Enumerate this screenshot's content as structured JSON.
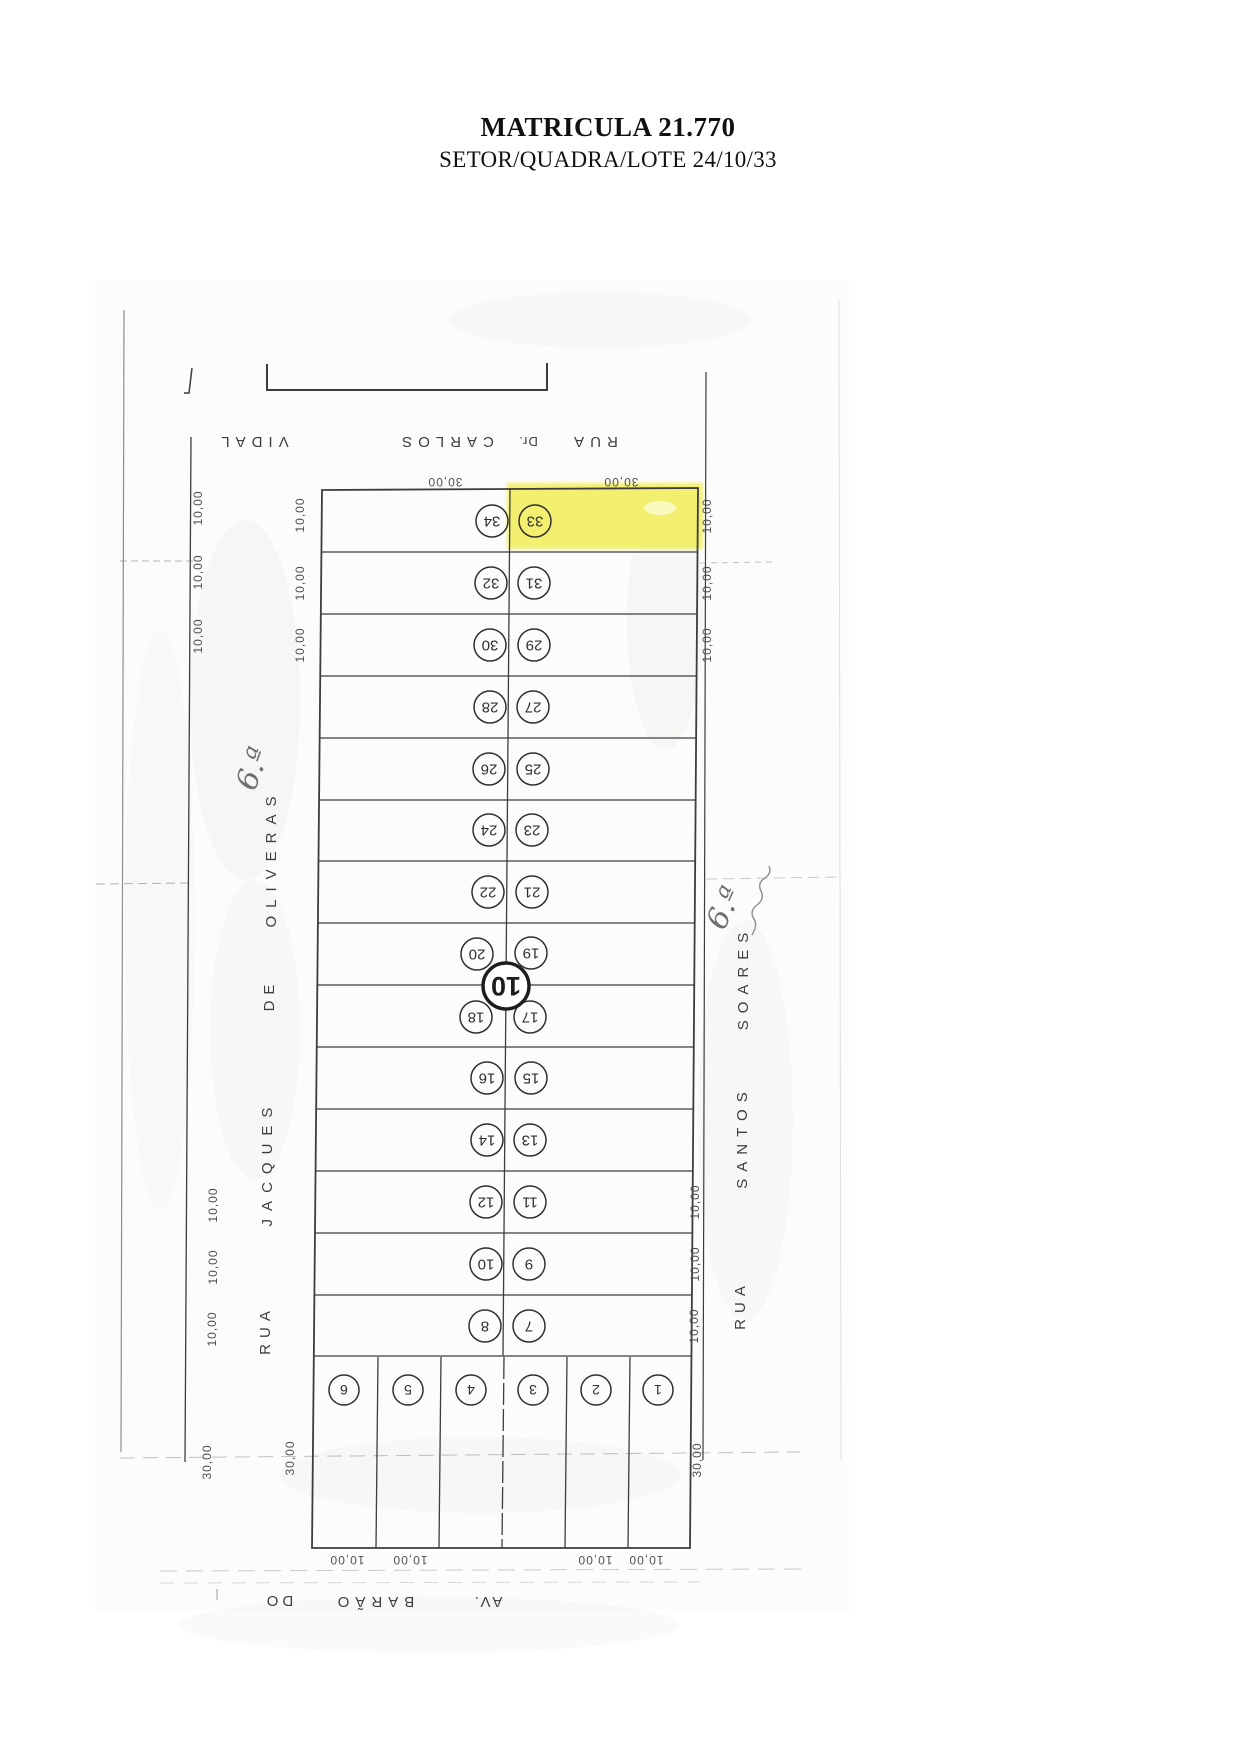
{
  "title": {
    "line1": "MATRICULA 21.770",
    "line2": "SETOR/QUADRA/LOTE 24/10/33"
  },
  "map": {
    "quadra_number": "10",
    "highlighted_lot": "33",
    "highlight_color": "#f2ee4d",
    "streets": {
      "top": [
        "RUA",
        "Dr.",
        "CARLOS",
        "VIDAL"
      ],
      "left": [
        "RUA",
        "JACQUES",
        "DE",
        "OLIVERAS"
      ],
      "right": [
        "RUA",
        "SANTOS",
        "SOARES"
      ],
      "bottom": [
        "AV.",
        "BARÃO",
        "DO"
      ]
    },
    "annotations": {
      "left": "6.ª",
      "right": "6.ª"
    },
    "rows": [
      {
        "left": "34",
        "right": "33"
      },
      {
        "left": "32",
        "right": "31"
      },
      {
        "left": "30",
        "right": "29"
      },
      {
        "left": "28",
        "right": "27"
      },
      {
        "left": "26",
        "right": "25"
      },
      {
        "left": "24",
        "right": "23"
      },
      {
        "left": "22",
        "right": "21"
      },
      {
        "left": "20",
        "right": "19"
      },
      {
        "left": "18",
        "right": "17"
      },
      {
        "left": "16",
        "right": "15"
      },
      {
        "left": "14",
        "right": "13"
      },
      {
        "left": "12",
        "right": "11"
      },
      {
        "left": "10",
        "right": "9"
      },
      {
        "left": "8",
        "right": "7"
      }
    ],
    "bottom_lots": [
      "6",
      "5",
      "4",
      "3",
      "2",
      "1"
    ],
    "dims": {
      "top": [
        "30,00",
        "30,00"
      ],
      "left_outer_top": [
        "10,00",
        "10,00",
        "10,00"
      ],
      "left_inner_top": [
        "10,00",
        "10,00",
        "10,00"
      ],
      "right_top": [
        "10,00",
        "10,00",
        "10,00"
      ],
      "left_bottom": [
        "10,00",
        "10,00",
        "10,00"
      ],
      "right_bottom": [
        "10,00",
        "10,00",
        "10,00"
      ],
      "left_30_outer": "30,00",
      "left_30_inner": "30,00",
      "right_30": "30,00",
      "bottom": [
        "10,00",
        "10,00",
        "10,00",
        "10,00"
      ]
    }
  }
}
